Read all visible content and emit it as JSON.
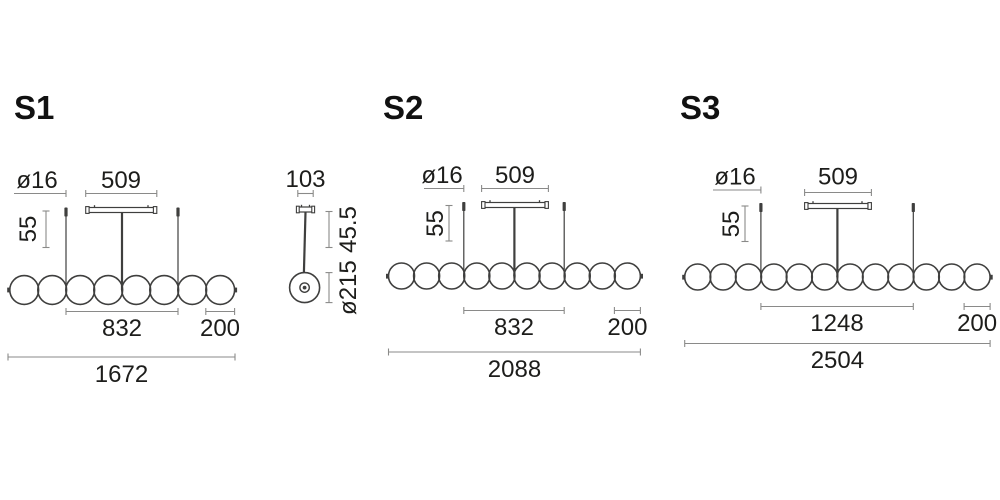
{
  "colors": {
    "background": "#ffffff",
    "drawing": "#3f3f3e",
    "dimension": "#8a8a89",
    "text": "#1d1d1b"
  },
  "variants": [
    {
      "id": "S1",
      "label": "S1",
      "sphere_count": 8,
      "dims": {
        "cable_diameter": "ø16",
        "canopy_length": "509",
        "top_offset": "55",
        "suspension_span": "832",
        "sphere_diameter": "200",
        "total_length": "1672"
      }
    },
    {
      "id": "S2",
      "label": "S2",
      "sphere_count": 10,
      "dims": {
        "cable_diameter": "ø16",
        "canopy_length": "509",
        "top_offset": "55",
        "suspension_span": "832",
        "sphere_diameter": "200",
        "total_length": "2088"
      }
    },
    {
      "id": "S3",
      "label": "S3",
      "sphere_count": 12,
      "dims": {
        "cable_diameter": "ø16",
        "canopy_length": "509",
        "top_offset": "55",
        "suspension_span": "1248",
        "sphere_diameter": "200",
        "total_length": "2504"
      }
    }
  ],
  "side_view": {
    "dims": {
      "canopy_width": "103",
      "top_height": "45.5",
      "sphere_diameter": "ø215"
    }
  }
}
